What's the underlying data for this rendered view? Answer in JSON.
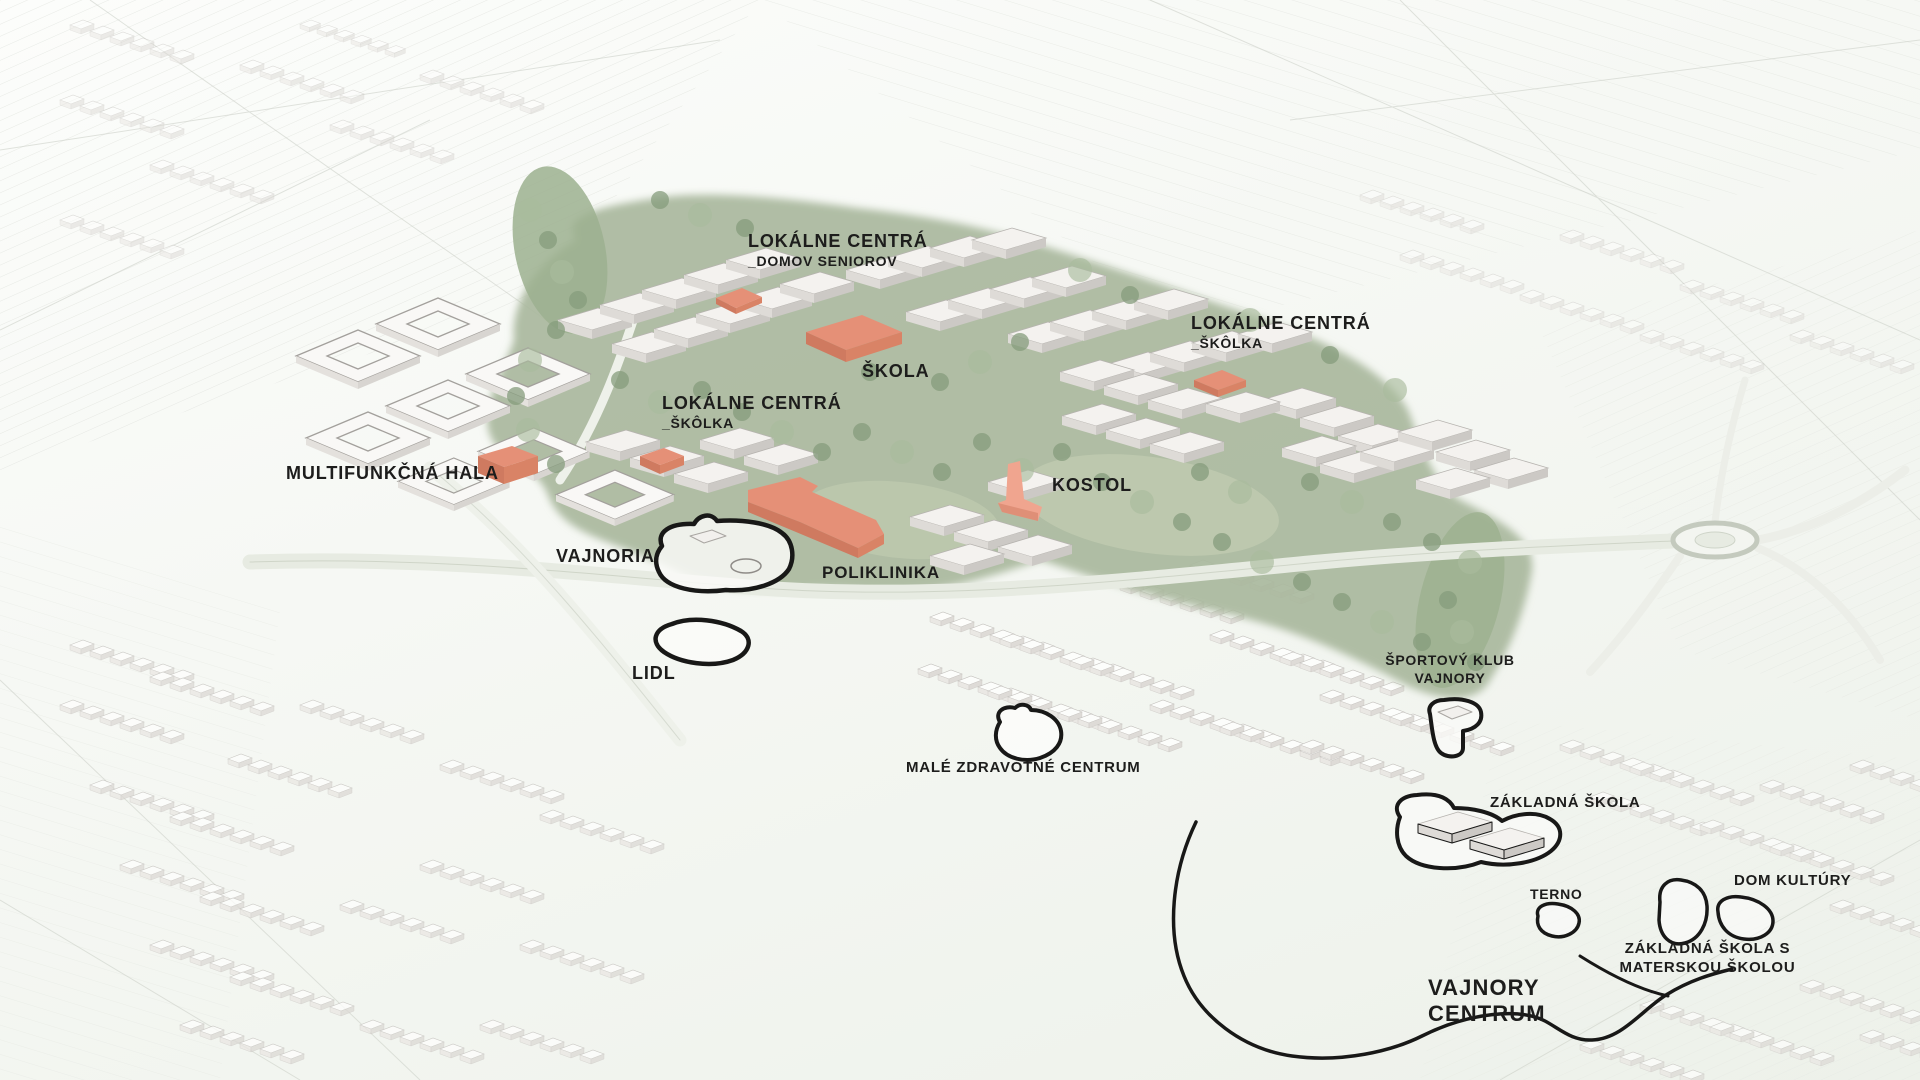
{
  "labels": {
    "lokalne_centra_domov": {
      "line1": "LOKÁLNE CENTRÁ",
      "line2": "_DOMOV SENIOROV"
    },
    "lokalne_centra_skolka_east": {
      "line1": "LOKÁLNE CENTRÁ",
      "line2": "_ŠKÔLKA"
    },
    "skola": {
      "text": "ŠKOLA"
    },
    "lokalne_centra_skolka_west": {
      "line1": "LOKÁLNE CENTRÁ",
      "line2": "_ŠKÔLKA"
    },
    "multifunkcna_hala": {
      "text": "MULTIFUNKČNÁ HALA"
    },
    "kostol": {
      "text": "KOSTOL"
    },
    "vajnoria": {
      "text": "VAJNORIA"
    },
    "poliklinika": {
      "text": "POLIKLINIKA"
    },
    "lidl": {
      "text": "LIDL"
    },
    "male_zdravotne_centrum": {
      "text": "MALÉ ZDRAVOTNÉ CENTRUM"
    },
    "sportovy_klub_vajnory": {
      "line1": "ŠPORTOVÝ KLUB",
      "line2": "VAJNORY"
    },
    "zakladna_skola": {
      "text": "ZÁKLADNÁ ŠKOLA"
    },
    "terno": {
      "text": "TERNO"
    },
    "dom_kultury": {
      "text": "DOM KULTÚRY"
    },
    "zakladna_skola_s_materskou": {
      "line1": "ZÁKLADNÁ ŠKOLA S",
      "line2": "MATERSKOU ŠKOLOU"
    },
    "vajnory_centrum": {
      "line1": "VAJNORY",
      "line2": "CENTRUM"
    }
  },
  "colors": {
    "accent_building": "#e59077",
    "accent_building_shade": "#cf7a60",
    "accent_building_light": "#f0a58f",
    "park_green": "#a9b99d",
    "tree_dark": "#869c7c",
    "tree_light": "#b9c6aa",
    "site_outline": "#181817",
    "label_text": "#1d1d1c",
    "building_top": "#f4f2ef",
    "building_side": "#d6d3cf",
    "background": "#f6f8f4"
  }
}
